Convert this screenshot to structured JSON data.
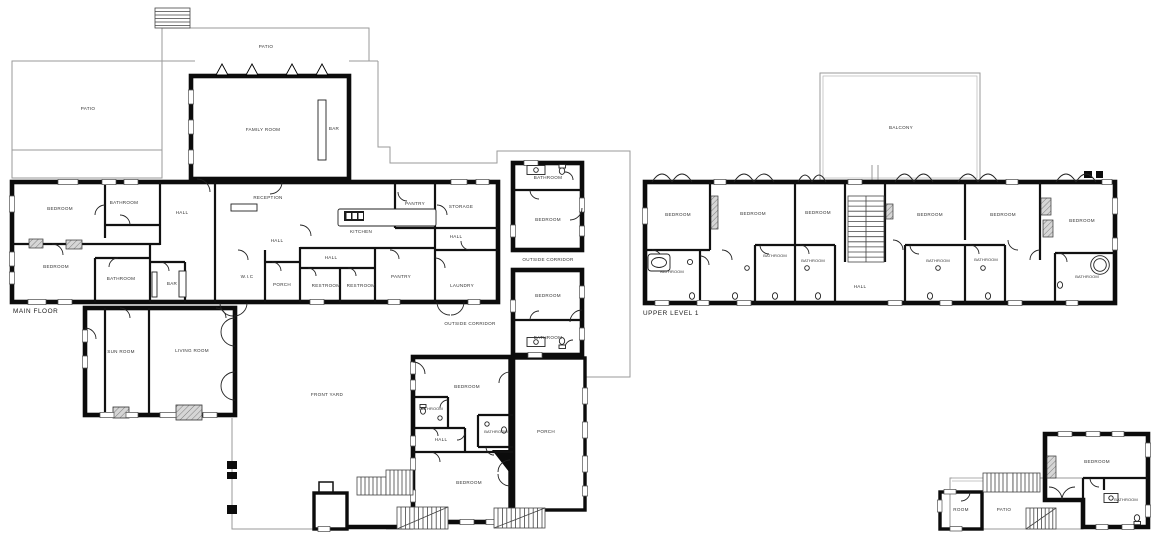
{
  "plans": {
    "main_floor": {
      "title": "MAIN FLOOR",
      "rooms": {
        "patio_left": "PATIO",
        "patio_top": "PATIO",
        "family_room": "FAMILY ROOM",
        "bar_family": "BAR",
        "bedroom_nw": "BEDROOM",
        "bathroom_nw": "BATHROOM",
        "hall_nw": "HALL",
        "reception": "RECEPTION",
        "kitchen": "KITCHEN",
        "pantry_top": "PANTRY",
        "storage": "STORAGE",
        "hall_storage": "HALL",
        "hall_center": "HALL",
        "hall_mid": "HALL",
        "bedroom_w": "BEDROOM",
        "bathroom_w": "BATHROOM",
        "bar_lounge": "BAR",
        "wic": "W.I.C",
        "porch_inner": "PORCH",
        "restroom_1": "RESTROOM",
        "restroom_2": "RESTROOM",
        "pantry_lower": "PANTRY",
        "laundry": "LAUNDRY",
        "bathroom_ne": "BATHROOM",
        "bedroom_ne": "BEDROOM",
        "outside_corridor_east": "OUTSIDE CORRIDOR",
        "bedroom_e": "BEDROOM",
        "bathroom_e": "BATHROOM",
        "outside_corridor_south": "OUTSIDE CORRIDOR",
        "sun_room": "SUN ROOM",
        "living_room": "LIVING ROOM",
        "front_yard": "FRONT YARD",
        "bedroom_s1": "BEDROOM",
        "bathroom_s1": "BATHROOM",
        "bathroom_s2": "BATHROOM",
        "hall_s": "HALL",
        "bedroom_s2": "BEDROOM",
        "porch_south": "PORCH"
      }
    },
    "upper_level": {
      "title": "UPPER LEVEL 1",
      "rooms": {
        "balcony": "BALCONY",
        "bedroom_1": "BEDROOM",
        "bedroom_2": "BEDROOM",
        "bedroom_3": "BEDROOM",
        "bedroom_4": "BEDROOM",
        "bedroom_5": "BEDROOM",
        "bedroom_6": "BEDROOM",
        "bathroom_1": "BATHROOM",
        "bathroom_2": "BATHROOM",
        "bathroom_3": "BATHROOM",
        "bathroom_4": "BATHROOM",
        "bathroom_5": "BATHROOM",
        "bathroom_6": "BATHROOM",
        "hall": "HALL"
      }
    },
    "guest_house": {
      "rooms": {
        "bedroom": "BEDROOM",
        "bathroom": "BATHROOM",
        "room": "ROOM",
        "patio": "PATIO"
      }
    }
  },
  "style": {
    "background": "#ffffff",
    "wall_color": "#0c0c0c",
    "thin_outline_color": "#9a9a9a",
    "label_color": "#333333"
  }
}
